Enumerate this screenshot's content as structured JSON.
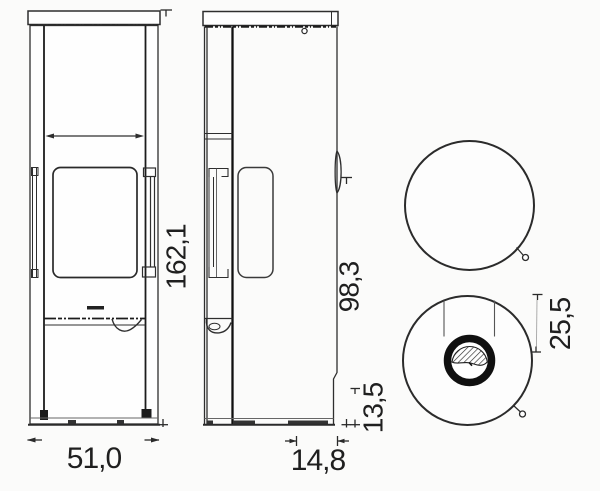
{
  "drawing": {
    "type": "technical-dimension-drawing",
    "subject": "freestanding-stove",
    "background_color": "#fbfbfa",
    "line_color": "#2e2e2e",
    "accent_black": "#101010",
    "views": [
      {
        "id": "front-view",
        "description": "front elevation with glass door and handle"
      },
      {
        "id": "side-view",
        "description": "side elevation with side window and rear recess"
      },
      {
        "id": "top-view-upper",
        "description": "plan view, plain top with door knob"
      },
      {
        "id": "top-view-lower",
        "description": "plan view with flue collar section and knob"
      }
    ],
    "dimensions": {
      "total_height": "162,1",
      "total_width": "51,0",
      "flue_outlet_height": "98,3",
      "rear_recess_height": "13,5",
      "rear_recess_depth": "14,8",
      "flue_center_to_rear": "25,5"
    }
  }
}
